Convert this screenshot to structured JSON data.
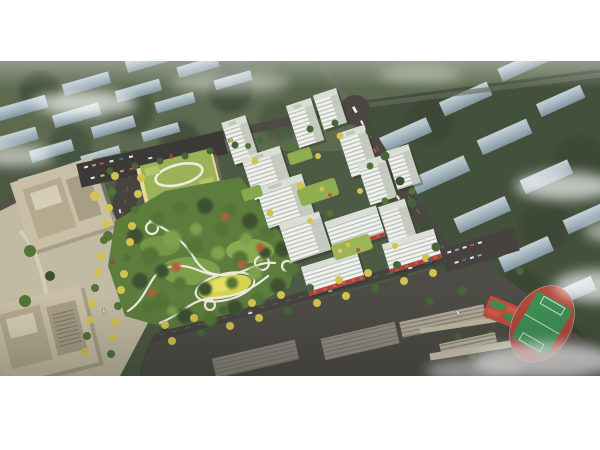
{
  "image": {
    "alt": "Aerial architectural rendering of a residential master plan: white high-rise apartment towers around landscaped courtyards, a large central park with winding white paths and a yellow lawn, a kindergarten with a green roof, tree-lined boulevards, beige office towers, a school campus with a running track and sports courts, and hazy rows of city buildings in the background under drifting mist"
  },
  "colors": {
    "page_bg": "#ffffff",
    "ground": "#4d5a44",
    "ground_far": "#5f6b52",
    "ground_east": "#42503c",
    "park_green": "#5d7d3d",
    "lawn_yellow": "#d6d44d",
    "path_white": "#eceadf",
    "road": "#4a4743",
    "road_minor": "#474440",
    "tower_face": "#eff1ec",
    "tower_shade": "#c3c7bc",
    "tower_roof": "#dadfd5",
    "storefront_red": "#b0403a",
    "school_roof": "#9cb257",
    "school_wall": "#e7d89c",
    "office_tan": "#c9bfa6",
    "plaza_tan": "#c3baa3",
    "campus_gray": "#b3ac9a",
    "bg_building": "#bccad3",
    "field_green": "#3f9055",
    "track_red": "#b3493a",
    "court_red": "#bf4f3e",
    "mist_white": "#ffffff"
  }
}
